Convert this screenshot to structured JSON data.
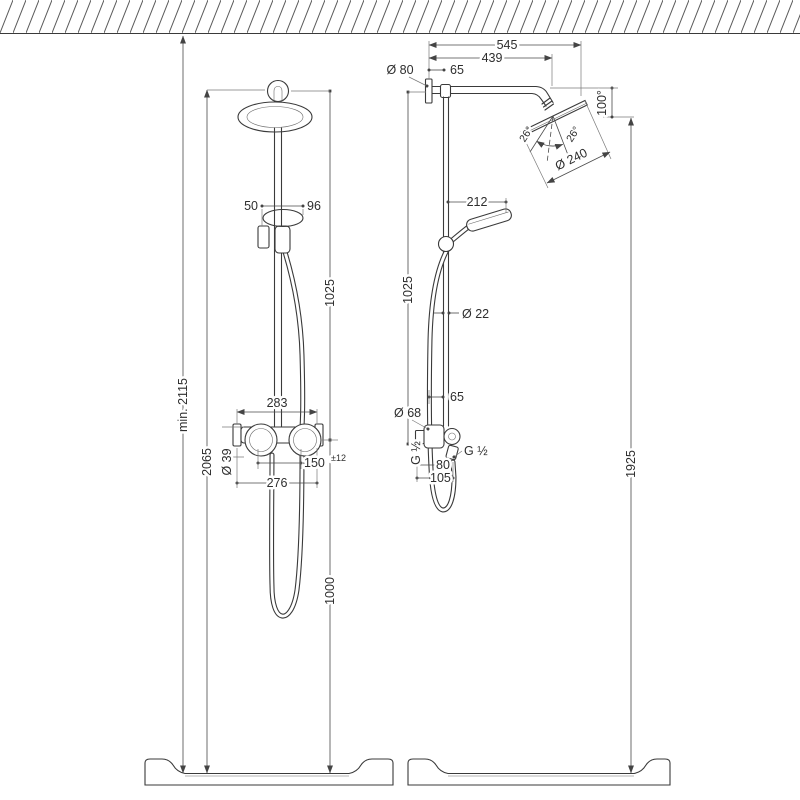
{
  "drawing": {
    "subject": "Shower pipe system — two-view technical dimension drawing",
    "background": "#ffffff",
    "line_color": "#3a3a3a",
    "dimension_color": "#4a4a4a",
    "text_color": "#2e2e2e"
  },
  "front_view": {
    "overall_min_height": "min. 2115",
    "pipe_top_height": "2065",
    "pipe_upper_length": "1025",
    "valve_to_floor": "1000",
    "holder_offset": "50",
    "handshower_offset": "96",
    "valve_width": "283",
    "valve_body_diameter": "Ø 39",
    "supply_centers": "150",
    "supply_tolerance": "±12",
    "escutcheon_centers": "276"
  },
  "side_view": {
    "arm_projection_overall": "545",
    "arm_projection_to_bend": "439",
    "flange_diameter": "Ø 80",
    "wall_to_riser": "65",
    "head_drop": "100°",
    "head_diameter": "Ø 240",
    "head_tilt_left": "26°",
    "head_tilt_right": "26°",
    "handshower_reach": "212",
    "bar_length": "1025",
    "bar_diameter": "Ø 22",
    "wall_to_bar": "65",
    "bracket_diameter": "Ø 68",
    "supply_thread": "G ½",
    "hose_thread": "G ½",
    "wall_to_supply": "80",
    "wall_to_hose": "105",
    "head_to_floor": "1925"
  }
}
